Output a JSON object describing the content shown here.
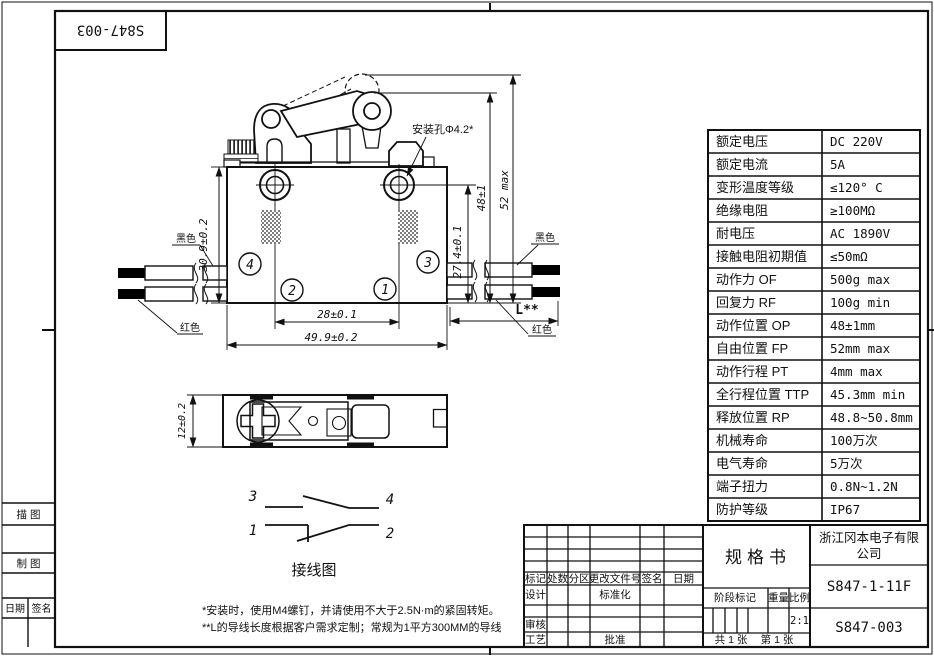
{
  "colors": {
    "ink": "#111111",
    "paper": "#ffffff"
  },
  "sheet": {
    "doc_no_rotated": "S847-003"
  },
  "left_strip": {
    "trace": "描 图",
    "draft": "制 图",
    "date": "日期",
    "sign": "签名"
  },
  "spec": {
    "rows": [
      {
        "label": "额定电压",
        "value": "DC 220V"
      },
      {
        "label": "额定电流",
        "value": "5A"
      },
      {
        "label": "变形温度等级",
        "value": "≤120° C"
      },
      {
        "label": "绝缘电阻",
        "value": "≥100MΩ"
      },
      {
        "label": "耐电压",
        "value": "AC 1890V"
      },
      {
        "label": "接触电阻初期值",
        "value": "≤50mΩ"
      },
      {
        "label": "动作力 OF",
        "value": "500g max"
      },
      {
        "label": "回复力 RF",
        "value": "100g min"
      },
      {
        "label": "动作位置 OP",
        "value": "48±1mm"
      },
      {
        "label": "自由位置 FP",
        "value": "52mm max"
      },
      {
        "label": "动作行程 PT",
        "value": "4mm max"
      },
      {
        "label": "全行程位置 TTP",
        "value": "45.3mm min"
      },
      {
        "label": "释放位置 RP",
        "value": "48.8~50.8mm"
      },
      {
        "label": "机械寿命",
        "value": "100万次"
      },
      {
        "label": "电气寿命",
        "value": "5万次"
      },
      {
        "label": "端子扭力",
        "value": "0.8N~1.2N"
      },
      {
        "label": "防护等级",
        "value": "IP67"
      }
    ]
  },
  "title_block": {
    "rev_cols": {
      "mark": "标记",
      "count": "处数",
      "zone": "分区",
      "change_doc": "更改文件号",
      "sign": "签名",
      "date": "日期"
    },
    "design": "设计",
    "standardize": "标准化",
    "audit": "审核",
    "process": "工艺",
    "approve": "批准",
    "spec_title": "规格书",
    "company_line1": "浙江冈本电子有限",
    "company_line2": "公司",
    "stage": "阶段标记",
    "weight": "重量",
    "scale": "比例",
    "scale_value": "2:1",
    "sheets_total": "共 1 张",
    "sheet_no": "第 1 张",
    "model": "S847-1-11F",
    "doc_no": "S847-003"
  },
  "drawing": {
    "dim_height": "30.9±0.2",
    "dim_hole_pitch": "28±0.1",
    "dim_width": "49.9±0.2",
    "dim_hole_bottom": "27.4±0.1",
    "dim_op": "48±1",
    "dim_fp": "52 max",
    "dim_wire": "L**",
    "dim_side": "12±0.2",
    "mount_hole": "安装孔Φ4.2*",
    "black": "黑色",
    "red": "红色",
    "t1": "1",
    "t2": "2",
    "t3": "3",
    "t4": "4",
    "wiring_title": "接线图"
  },
  "notes": {
    "n1": "*安装时，使用M4螺钉，并请使用不大于2.5N·m的紧固转矩。",
    "n2": "**L的导线长度根据客户需求定制；常规为1平方300MM的导线"
  }
}
